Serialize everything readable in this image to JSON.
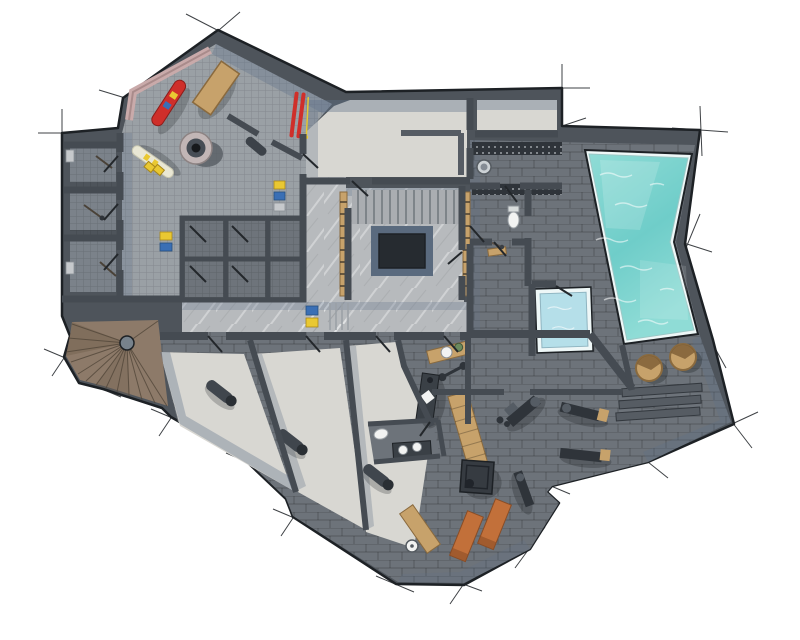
{
  "title": "Basement floor plan – ski room, cellars, spa with pool and gym (top-down 3D render)",
  "colors": {
    "paper": "#ffffff",
    "outline": "#1d2125",
    "wall": "#4e545b",
    "innerWall": "#454b52",
    "door": "#23272b",
    "tileGray": "#9aa0a5",
    "tileDark": "#7b828a",
    "lockerFloor": "#6e747b",
    "marble": "#b7babd",
    "plaster": "#d8d7d2",
    "brickDark": "#6d737a",
    "treadGray": "#aaadb1",
    "poolWater": "#8fdcd6",
    "poolWaterDeep": "#6fcdc9",
    "poolRim": "#eef7f7",
    "plungeWater": "#b5dfe9",
    "wood": "#c7a26b",
    "woodDark": "#8a6a3e",
    "stairWood": "#8d7a69",
    "stairWoodDark": "#74624f",
    "shadow": "#5f7089",
    "objectDark": "#2f343a",
    "objectMid": "#555c64",
    "matOrange": "#c2703a",
    "red": "#cf2f2a",
    "yellow": "#e9c832",
    "blue": "#3a6fb5",
    "white": "#f2f3f2",
    "pink": "#c9aaaa",
    "plant": "#6b8a5e"
  },
  "elements": {
    "rooms": [
      "ski-room",
      "storage-cellars",
      "ski-lockers",
      "corridor",
      "main-staircase",
      "technical-rooms",
      "sauna",
      "pool-deck",
      "swimming-pool",
      "plunge-pool",
      "gym",
      "massage-room",
      "relax-rooms",
      "wc",
      "spiral-staircase"
    ],
    "objects": [
      "snowboard",
      "skis",
      "wooden-bench",
      "floor-drain",
      "sauna-stove",
      "toilet",
      "sink",
      "massage-table",
      "exercise-machine",
      "gym-mat",
      "wooden-tub",
      "pool-steps",
      "plyo-box",
      "rolled-mat"
    ]
  }
}
